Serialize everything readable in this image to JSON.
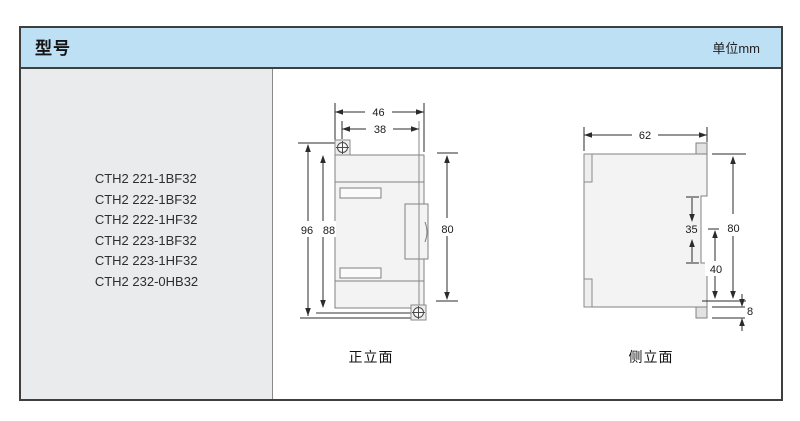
{
  "header": {
    "title": "型号",
    "unit_label": "单位mm"
  },
  "model_panel": {
    "models": [
      "CTH2 221-1BF32",
      "CTH2 222-1BF32",
      "CTH2 222-1HF32",
      "CTH2 223-1BF32",
      "CTH2 223-1HF32",
      "CTH2 232-0HB32"
    ]
  },
  "front_view": {
    "label": "正立面",
    "dims": {
      "outer_width": "46",
      "mount_width": "38",
      "total_height": "96",
      "body_height": "88",
      "panel_height": "80"
    }
  },
  "side_view": {
    "label": "侧立面",
    "dims": {
      "depth": "62",
      "din_clip_height": "35",
      "lower_depth": "40",
      "panel_height": "80",
      "tab_height": "8"
    }
  },
  "colors": {
    "header_bg": "#bde0f5",
    "panel_bg": "#eaebec",
    "frame_border": "#3f3f3f",
    "drawing_outline": "#808080",
    "dimension_line": "#2b2b2b"
  }
}
